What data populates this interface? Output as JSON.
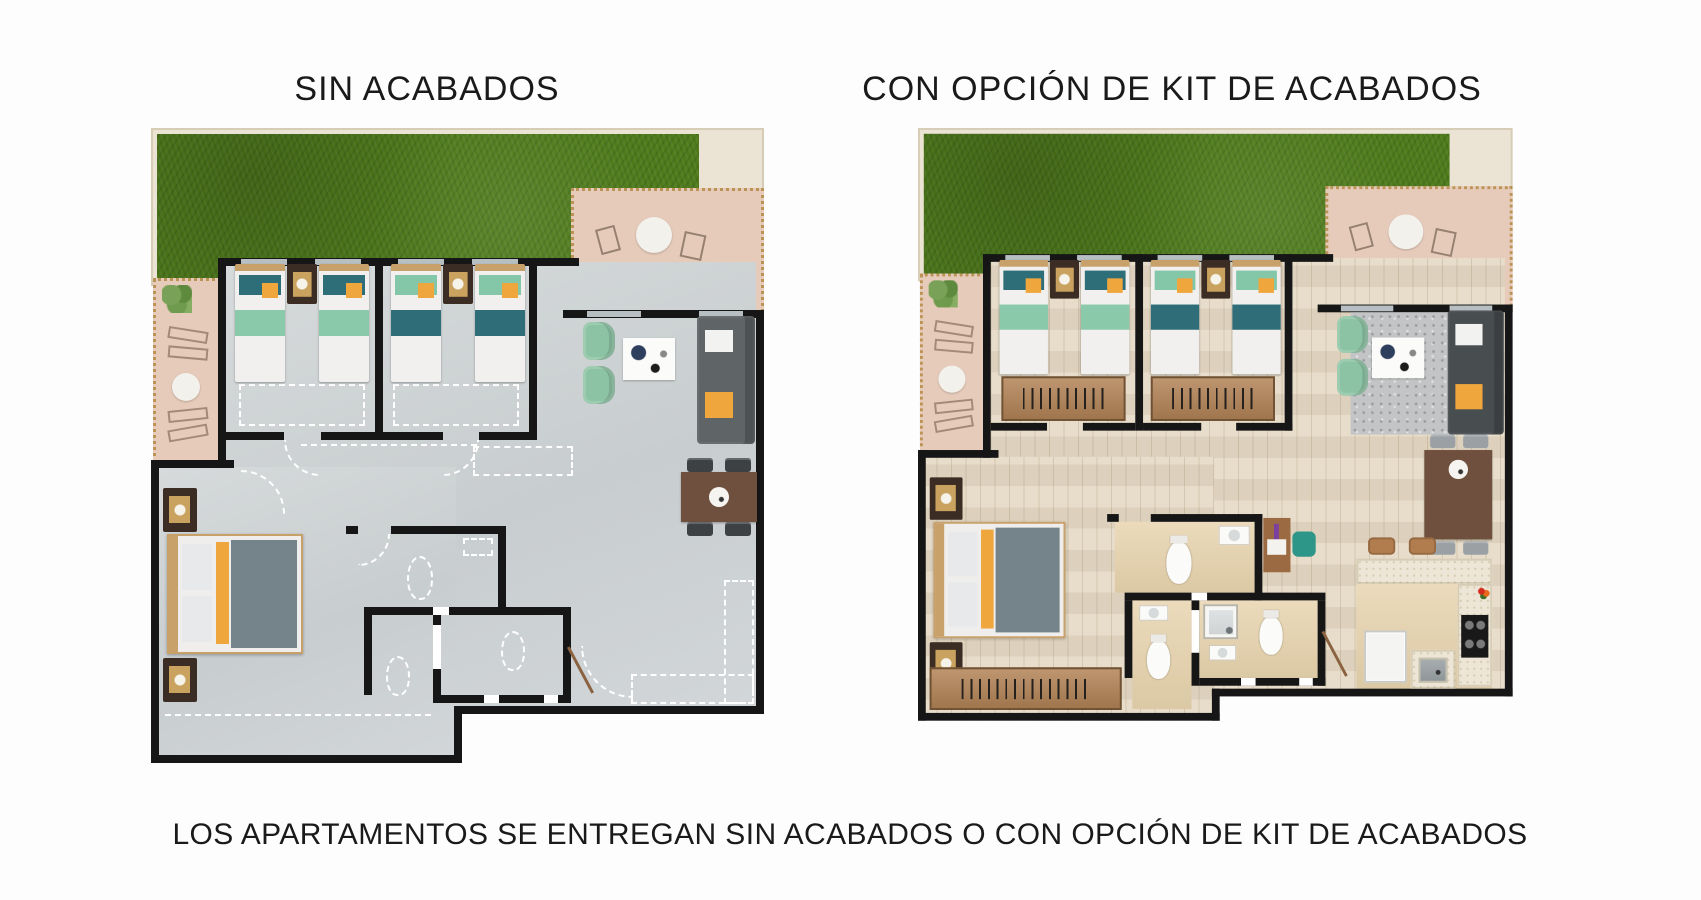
{
  "header": {
    "left_title": "SIN ACABADOS",
    "right_title": "CON OPCIÓN DE KIT DE ACABADOS"
  },
  "plans": [
    {
      "id": "sin-acabados",
      "title": "SIN ACABADOS",
      "finish": "bare"
    },
    {
      "id": "kit-de-acabados",
      "title": "CON OPCIÓN DE KIT DE ACABADOS",
      "finish": "finished"
    }
  ],
  "footer": {
    "caption": "LOS APARTAMENTOS SE ENTREGAN SIN ACABADOS O CON OPCIÓN DE KIT DE ACABADOS"
  },
  "colors": {
    "bg_page": "#fdfdfd",
    "text": "#1a1a1a",
    "wall": "#161616",
    "window_glass": "#b7bfc2",
    "grass": "#4e7a1b",
    "terrace": "#e7cbba",
    "terrace_border": "#bb9355",
    "floor_bare": "#ced3d5",
    "floor_wood": "#e4d8c3",
    "floor_tile": "#e7d3ad",
    "dash": "#ffffff",
    "bed_teal": "#2e6e79",
    "bed_seafoam": "#8bc9ab",
    "pillow_yellow": "#efa63d",
    "blanket_slate": "#75848b",
    "wood_trim": "#c8a06a",
    "nightstand": "#3c2d24",
    "sofa_bare": "#5f6467",
    "sofa_kit": "#484d50",
    "armchair": "#8cc3a4",
    "table_brown": "#6f4f3d",
    "chair_dark": "#3e4144",
    "marble": "#ede6d6",
    "stove": "#191919",
    "chair_teal": "#2e9688",
    "rug": "#c2c4c5",
    "plant": "#6f9b4e",
    "stool": "#b17c4e",
    "wardrobe": "#b28356",
    "fridge": "#f4f4f2"
  }
}
